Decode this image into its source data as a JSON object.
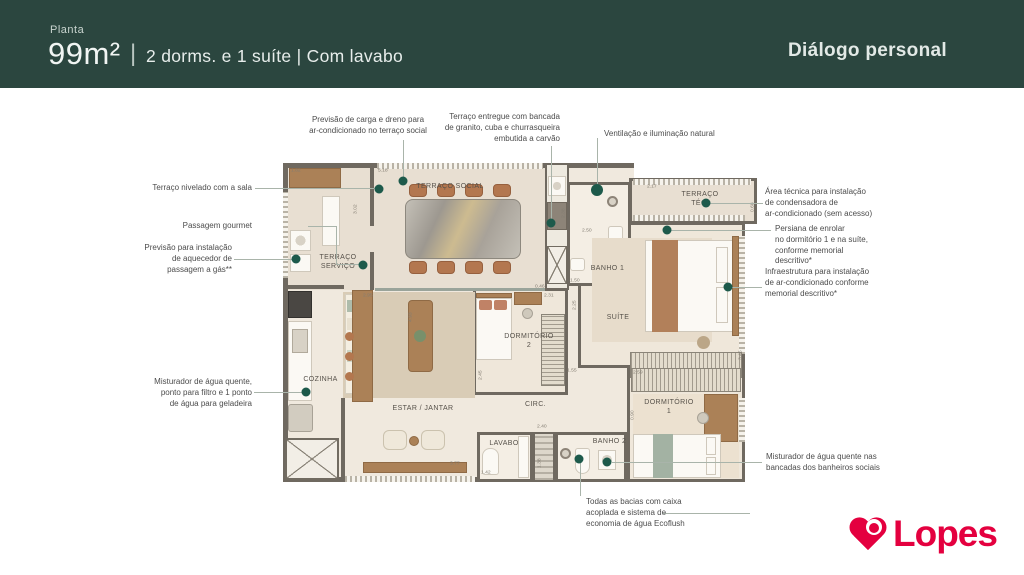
{
  "header": {
    "eyebrow": "Planta",
    "area": "99m²",
    "divider": "|",
    "subtitle": "2 dorms. e 1 suíte | Com lavabo",
    "brand": "Diálogo personal"
  },
  "colors": {
    "header_bg": "#2b463f",
    "callout_dot": "#1d5a4b",
    "wall": "#6f6960",
    "logo_red": "#e4003f"
  },
  "plan": {
    "rooms": [
      "TERRAÇO SOCIAL",
      "TERRAÇO\nSERVIÇO",
      "TERRAÇO\nTÉC.",
      "BANHO 1",
      "SUÍTE",
      "DORMITÓRIO\n2",
      "COZINHA",
      "ESTAR / JANTAR",
      "CIRC.",
      "LAVABO",
      "BANHO 2",
      "DORMITÓRIO\n1"
    ],
    "dims": [
      "1.82",
      "5.18",
      "3.02",
      "2.38",
      "2.17",
      "0.68",
      "2.50",
      "1.50",
      "2.25",
      "2.95",
      "4.93",
      "2.31",
      "2.45",
      "1.55",
      "3.45",
      "2.59",
      "0.90",
      "2.40",
      "1.42",
      "1.38",
      "3.77",
      "0.46"
    ]
  },
  "callouts": [
    {
      "id": "carga-dreno",
      "text": "Previsão de carga e dreno para\nar-condicionado no terraço social"
    },
    {
      "id": "terraco-entregue",
      "text": "Terraço entregue com bancada\nde granito, cuba e churrasqueira\nembutida a carvão"
    },
    {
      "id": "ventilacao",
      "text": "Ventilação e iluminação natural"
    },
    {
      "id": "area-tecnica",
      "text": "Área técnica para instalação\nde condensadora de\nar-condicionado (sem acesso)"
    },
    {
      "id": "persiana",
      "text": "Persiana de enrolar\nno dormitório 1 e na suíte,\nconforme memorial\ndescritivo*"
    },
    {
      "id": "infraestrutura",
      "text": "Infraestrutura para instalação\nde ar-condicionado conforme\nmemorial descritivo*"
    },
    {
      "id": "terraco-nivelado",
      "text": "Terraço nivelado com a sala"
    },
    {
      "id": "passagem-gourmet",
      "text": "Passagem gourmet"
    },
    {
      "id": "aquecedor",
      "text": "Previsão para instalação\nde aquecedor de\npassagem a gás**"
    },
    {
      "id": "misturador-cozinha",
      "text": "Misturador de água quente,\nponto para filtro e 1 ponto\nde água para geladeira"
    },
    {
      "id": "misturador-banheiros",
      "text": "Misturador de água quente nas\nbancadas dos banheiros sociais"
    },
    {
      "id": "bacias-ecoflush",
      "text": "Todas as bacias com caixa\nacoplada e sistema de\neconomia de água Ecoflush"
    }
  ],
  "logo": {
    "text": "Lopes"
  }
}
